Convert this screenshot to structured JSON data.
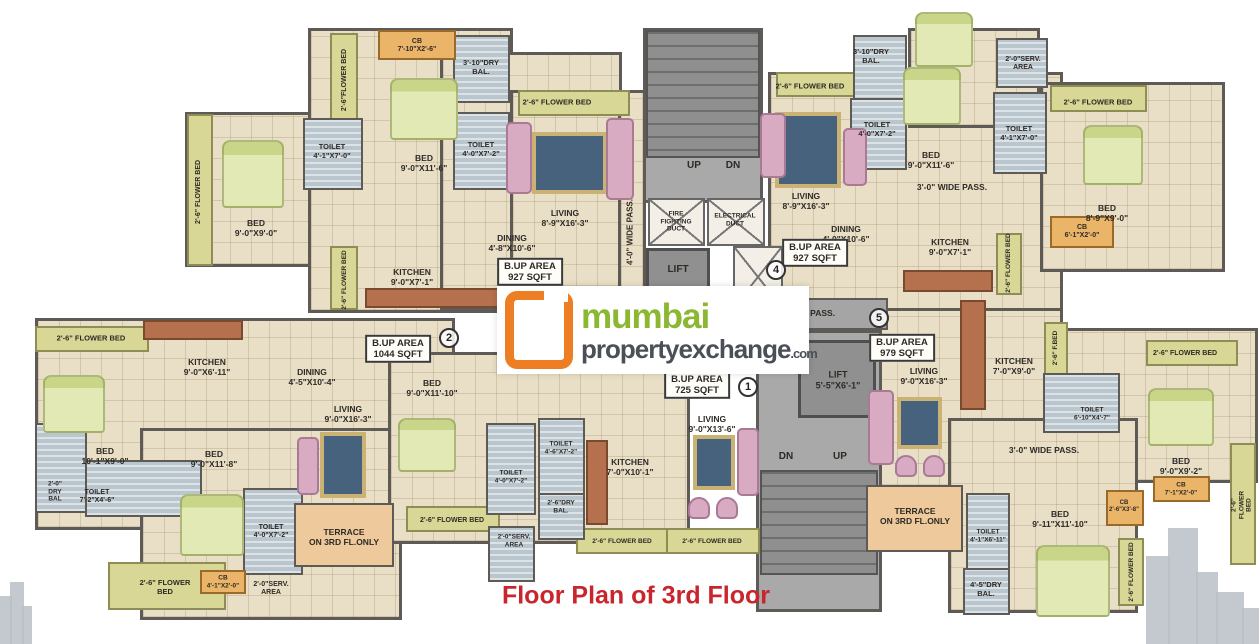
{
  "caption": "Floor Plan of 3rd Floor",
  "logo": {
    "icon": "orange-square-bracket",
    "line1": "mumbai",
    "line2": "propertyexchange",
    "suffix": ".com"
  },
  "colors": {
    "floor": "#e9dfc6",
    "wall": "#5e5a55",
    "flower_bed": "#d8d795",
    "wet_area": "#b9c6ce",
    "cupboard": "#eab469",
    "terrace": "#eec99b",
    "core": "#a9a9a9",
    "logo_orange": "#ee7e23",
    "logo_green": "#8cb733",
    "logo_gray": "#4b5058",
    "caption_red": "#c9252d",
    "bed": "#e2e9b4",
    "rug": "#46627c",
    "sofa": "#d9abc3"
  },
  "plan": {
    "regions": [
      {
        "type": "f",
        "x": 185,
        "y": 112,
        "w": 130,
        "h": 155
      },
      {
        "type": "f",
        "x": 308,
        "y": 28,
        "w": 205,
        "h": 285
      },
      {
        "type": "f",
        "x": 440,
        "y": 52,
        "w": 182,
        "h": 258
      },
      {
        "type": "f",
        "x": 510,
        "y": 90,
        "w": 115,
        "h": 220
      },
      {
        "type": "f",
        "x": 618,
        "y": 90,
        "w": 28,
        "h": 222
      },
      {
        "type": "f",
        "x": 768,
        "y": 72,
        "w": 295,
        "h": 240
      },
      {
        "type": "f",
        "x": 1040,
        "y": 82,
        "w": 185,
        "h": 190
      },
      {
        "type": "f",
        "x": 908,
        "y": 28,
        "w": 132,
        "h": 100
      },
      {
        "type": "f",
        "x": 35,
        "y": 318,
        "w": 420,
        "h": 212
      },
      {
        "type": "f",
        "x": 140,
        "y": 428,
        "w": 262,
        "h": 192
      },
      {
        "type": "f",
        "x": 388,
        "y": 352,
        "w": 302,
        "h": 192
      },
      {
        "type": "f",
        "x": 873,
        "y": 308,
        "w": 190,
        "h": 180
      },
      {
        "type": "f",
        "x": 1058,
        "y": 328,
        "w": 200,
        "h": 155
      },
      {
        "type": "f",
        "x": 948,
        "y": 418,
        "w": 190,
        "h": 195
      },
      {
        "type": "core",
        "x": 643,
        "y": 28,
        "w": 120,
        "h": 175
      },
      {
        "type": "stairs",
        "x": 646,
        "y": 30,
        "w": 114,
        "h": 128
      },
      {
        "type": "duct",
        "x": 648,
        "y": 198,
        "w": 57,
        "h": 48
      },
      {
        "type": "duct",
        "x": 707,
        "y": 198,
        "w": 58,
        "h": 48
      },
      {
        "type": "lift",
        "x": 646,
        "y": 248,
        "w": 64,
        "h": 58
      },
      {
        "type": "duct",
        "x": 733,
        "y": 246,
        "w": 50,
        "h": 62
      },
      {
        "type": "corridor",
        "x": 640,
        "y": 298,
        "w": 248,
        "h": 32
      },
      {
        "type": "core",
        "x": 756,
        "y": 330,
        "w": 126,
        "h": 282
      },
      {
        "type": "lift",
        "x": 798,
        "y": 340,
        "w": 78,
        "h": 78
      },
      {
        "type": "stairs",
        "x": 760,
        "y": 470,
        "w": 118,
        "h": 105
      },
      {
        "type": "fl",
        "x": 187,
        "y": 114,
        "w": 26,
        "h": 152
      },
      {
        "type": "fl",
        "x": 330,
        "y": 33,
        "w": 28,
        "h": 92
      },
      {
        "type": "fl",
        "x": 518,
        "y": 90,
        "w": 112,
        "h": 26
      },
      {
        "type": "fl",
        "x": 330,
        "y": 246,
        "w": 28,
        "h": 64
      },
      {
        "type": "fl",
        "x": 776,
        "y": 72,
        "w": 92,
        "h": 25
      },
      {
        "type": "fl",
        "x": 1050,
        "y": 85,
        "w": 97,
        "h": 27
      },
      {
        "type": "fl",
        "x": 996,
        "y": 233,
        "w": 26,
        "h": 62
      },
      {
        "type": "fl",
        "x": 35,
        "y": 326,
        "w": 114,
        "h": 26
      },
      {
        "type": "fl",
        "x": 108,
        "y": 562,
        "w": 118,
        "h": 48
      },
      {
        "type": "fl",
        "x": 406,
        "y": 506,
        "w": 94,
        "h": 26
      },
      {
        "type": "fl",
        "x": 576,
        "y": 528,
        "w": 94,
        "h": 26
      },
      {
        "type": "fl",
        "x": 666,
        "y": 528,
        "w": 94,
        "h": 26
      },
      {
        "type": "fl",
        "x": 1044,
        "y": 322,
        "w": 24,
        "h": 58
      },
      {
        "type": "fl",
        "x": 1118,
        "y": 538,
        "w": 26,
        "h": 68
      },
      {
        "type": "fl",
        "x": 1146,
        "y": 340,
        "w": 92,
        "h": 26
      },
      {
        "type": "fl",
        "x": 1230,
        "y": 443,
        "w": 26,
        "h": 122
      },
      {
        "type": "h",
        "x": 453,
        "y": 35,
        "w": 57,
        "h": 68
      },
      {
        "type": "h",
        "x": 303,
        "y": 118,
        "w": 60,
        "h": 72
      },
      {
        "type": "h",
        "x": 453,
        "y": 112,
        "w": 57,
        "h": 78
      },
      {
        "type": "h",
        "x": 853,
        "y": 35,
        "w": 54,
        "h": 88
      },
      {
        "type": "h",
        "x": 850,
        "y": 98,
        "w": 57,
        "h": 72
      },
      {
        "type": "h",
        "x": 993,
        "y": 92,
        "w": 54,
        "h": 82
      },
      {
        "type": "h",
        "x": 996,
        "y": 38,
        "w": 52,
        "h": 50
      },
      {
        "type": "h",
        "x": 35,
        "y": 423,
        "w": 52,
        "h": 90
      },
      {
        "type": "h",
        "x": 85,
        "y": 460,
        "w": 117,
        "h": 57
      },
      {
        "type": "h",
        "x": 243,
        "y": 488,
        "w": 60,
        "h": 87
      },
      {
        "type": "h",
        "x": 486,
        "y": 423,
        "w": 50,
        "h": 92
      },
      {
        "type": "h",
        "x": 538,
        "y": 418,
        "w": 47,
        "h": 77
      },
      {
        "type": "h",
        "x": 538,
        "y": 493,
        "w": 47,
        "h": 47
      },
      {
        "type": "h",
        "x": 488,
        "y": 526,
        "w": 47,
        "h": 56
      },
      {
        "type": "h",
        "x": 966,
        "y": 493,
        "w": 44,
        "h": 77
      },
      {
        "type": "h",
        "x": 963,
        "y": 568,
        "w": 47,
        "h": 47
      },
      {
        "type": "h",
        "x": 1043,
        "y": 373,
        "w": 77,
        "h": 60
      },
      {
        "type": "cb",
        "x": 378,
        "y": 30,
        "w": 78,
        "h": 30
      },
      {
        "type": "cb",
        "x": 1050,
        "y": 216,
        "w": 64,
        "h": 32
      },
      {
        "type": "cb",
        "x": 200,
        "y": 570,
        "w": 46,
        "h": 24
      },
      {
        "type": "cb",
        "x": 1153,
        "y": 476,
        "w": 57,
        "h": 26
      },
      {
        "type": "cb",
        "x": 1106,
        "y": 490,
        "w": 38,
        "h": 36
      },
      {
        "type": "t",
        "x": 294,
        "y": 503,
        "w": 100,
        "h": 64
      },
      {
        "type": "t",
        "x": 866,
        "y": 485,
        "w": 97,
        "h": 67
      }
    ],
    "furniture": [
      {
        "type": "bed",
        "x": 390,
        "y": 78,
        "w": 68,
        "h": 62
      },
      {
        "type": "bed",
        "x": 222,
        "y": 140,
        "w": 62,
        "h": 68
      },
      {
        "type": "bed",
        "x": 903,
        "y": 67,
        "w": 58,
        "h": 58
      },
      {
        "type": "bed",
        "x": 1083,
        "y": 125,
        "w": 60,
        "h": 60
      },
      {
        "type": "bed",
        "x": 915,
        "y": 12,
        "w": 58,
        "h": 55
      },
      {
        "type": "bed",
        "x": 43,
        "y": 375,
        "w": 62,
        "h": 58
      },
      {
        "type": "bed",
        "x": 180,
        "y": 494,
        "w": 64,
        "h": 62
      },
      {
        "type": "bed",
        "x": 398,
        "y": 418,
        "w": 58,
        "h": 54
      },
      {
        "type": "bed",
        "x": 1036,
        "y": 545,
        "w": 74,
        "h": 72
      },
      {
        "type": "bed",
        "x": 1148,
        "y": 388,
        "w": 66,
        "h": 58
      },
      {
        "type": "rug",
        "x": 532,
        "y": 132,
        "w": 75,
        "h": 62
      },
      {
        "type": "rug",
        "x": 775,
        "y": 112,
        "w": 66,
        "h": 76
      },
      {
        "type": "rug",
        "x": 320,
        "y": 432,
        "w": 46,
        "h": 66
      },
      {
        "type": "rug",
        "x": 693,
        "y": 435,
        "w": 42,
        "h": 55
      },
      {
        "type": "rug",
        "x": 897,
        "y": 397,
        "w": 45,
        "h": 52
      },
      {
        "type": "sofa",
        "x": 506,
        "y": 122,
        "w": 26,
        "h": 72
      },
      {
        "type": "sofa",
        "x": 606,
        "y": 118,
        "w": 28,
        "h": 82
      },
      {
        "type": "sofa",
        "x": 760,
        "y": 113,
        "w": 26,
        "h": 65
      },
      {
        "type": "sofa",
        "x": 843,
        "y": 128,
        "w": 24,
        "h": 58
      },
      {
        "type": "sofa",
        "x": 297,
        "y": 437,
        "w": 22,
        "h": 58
      },
      {
        "type": "sofa",
        "x": 737,
        "y": 428,
        "w": 22,
        "h": 68
      },
      {
        "type": "sofa",
        "x": 868,
        "y": 390,
        "w": 26,
        "h": 75
      },
      {
        "type": "chair",
        "x": 688,
        "y": 497,
        "w": 22,
        "h": 22
      },
      {
        "type": "chair",
        "x": 716,
        "y": 497,
        "w": 22,
        "h": 22
      },
      {
        "type": "chair",
        "x": 895,
        "y": 455,
        "w": 22,
        "h": 22
      },
      {
        "type": "chair",
        "x": 923,
        "y": 455,
        "w": 22,
        "h": 22
      },
      {
        "type": "counter",
        "x": 365,
        "y": 288,
        "w": 135,
        "h": 20
      },
      {
        "type": "counter",
        "x": 903,
        "y": 270,
        "w": 90,
        "h": 22
      },
      {
        "type": "counter",
        "x": 143,
        "y": 320,
        "w": 100,
        "h": 20
      },
      {
        "type": "counter",
        "x": 586,
        "y": 440,
        "w": 22,
        "h": 85
      },
      {
        "type": "counter",
        "x": 960,
        "y": 300,
        "w": 26,
        "h": 110
      }
    ]
  },
  "labels": [
    {
      "t": "2'-6\"FLOWER BED",
      "x": 345,
      "y": 80,
      "r": 1,
      "s": 7
    },
    {
      "t": "CB\n7'-10\"X2'-6\"",
      "x": 417,
      "y": 46,
      "s": 7
    },
    {
      "t": "3'-10\"DRY\nBAL.",
      "x": 481,
      "y": 68,
      "s": 7.5
    },
    {
      "t": "2'-6\" FLOWER BED",
      "x": 557,
      "y": 103,
      "s": 7.5
    },
    {
      "t": "TOILET\n4'-1\"X7'-0\"",
      "x": 332,
      "y": 152,
      "s": 7.5
    },
    {
      "t": "TOILET\n4'-0\"X7'-2\"",
      "x": 481,
      "y": 150,
      "s": 7.5
    },
    {
      "t": "BED\n9'-0\"X11'-6\"",
      "x": 424,
      "y": 163,
      "s": 8.5
    },
    {
      "t": "2'-6\" FLOWER BED",
      "x": 199,
      "y": 192,
      "r": 1,
      "s": 7
    },
    {
      "t": "BED\n9'-0\"X9'-0\"",
      "x": 256,
      "y": 228,
      "s": 8.5
    },
    {
      "t": "KITCHEN\n9'-0\"X7'-1\"",
      "x": 412,
      "y": 277,
      "s": 8.5
    },
    {
      "t": "2'-6\" FLOWER BED",
      "x": 345,
      "y": 280,
      "r": 1,
      "s": 6.5
    },
    {
      "t": "LIVING\n8'-9\"X16'-3\"",
      "x": 565,
      "y": 218,
      "s": 8.5
    },
    {
      "t": "DINING\n4'-8\"X10'-6\"",
      "x": 512,
      "y": 243,
      "s": 8.5
    },
    {
      "t": "B.UP AREA\n927 SQFT",
      "x": 530,
      "y": 272,
      "box": 1
    },
    {
      "t": "4'-0\" WIDE PASS.",
      "x": 630,
      "y": 232,
      "r": 1,
      "s": 8
    },
    {
      "t": "UP",
      "x": 694,
      "y": 166,
      "s": 10
    },
    {
      "t": "DN",
      "x": 733,
      "y": 166,
      "s": 10
    },
    {
      "t": "FIRE\nFIGHTING\nDUCT",
      "x": 676,
      "y": 222,
      "s": 6.5
    },
    {
      "t": "ELECTRICAL\nDUCT",
      "x": 735,
      "y": 220,
      "s": 6.5
    },
    {
      "t": "LIFT",
      "x": 678,
      "y": 270,
      "s": 10
    },
    {
      "t": "2'-6\" FLOWER BED",
      "x": 810,
      "y": 87,
      "s": 7.5
    },
    {
      "t": "3'-10\"DRY\nBAL.",
      "x": 871,
      "y": 57,
      "s": 7.5
    },
    {
      "t": "TOILET\n4'-0\"X7'-2\"",
      "x": 877,
      "y": 130,
      "s": 7.5
    },
    {
      "t": "BED\n9'-0\"X11'-6\"",
      "x": 931,
      "y": 160,
      "s": 8.5
    },
    {
      "t": "LIVING\n8'-9\"X16'-3\"",
      "x": 806,
      "y": 201,
      "s": 8.5
    },
    {
      "t": "DINING\n4'-0\"X10'-6\"",
      "x": 846,
      "y": 234,
      "s": 8.5
    },
    {
      "t": "B.UP AREA\n927 SQFT",
      "x": 815,
      "y": 253,
      "box": 1
    },
    {
      "t": "3'-0\" WIDE PASS.",
      "x": 952,
      "y": 187,
      "s": 8.5
    },
    {
      "t": "KITCHEN\n9'-0\"X7'-1\"",
      "x": 950,
      "y": 247,
      "s": 8.5
    },
    {
      "t": "2'-0\"SERV.\nAREA",
      "x": 1023,
      "y": 64,
      "s": 7
    },
    {
      "t": "TOILET\n4'-1\"X7'-0\"",
      "x": 1019,
      "y": 134,
      "s": 7.5
    },
    {
      "t": "2'-6\" FLOWER BED",
      "x": 1098,
      "y": 103,
      "s": 7.5
    },
    {
      "t": "BED\n8'-9\"X9'-0\"",
      "x": 1107,
      "y": 213,
      "s": 8.5
    },
    {
      "t": "CB\n6'-1\"X2'-0\"",
      "x": 1082,
      "y": 232,
      "s": 7
    },
    {
      "t": "2'-6\" FLOWER BED",
      "x": 1009,
      "y": 263,
      "r": 1,
      "s": 6.5
    },
    {
      "t": "4'-0\" WIDE PASS.",
      "x": 800,
      "y": 313,
      "s": 8.5
    },
    {
      "t": "2'-6\" FLOWER BED",
      "x": 91,
      "y": 339,
      "s": 7.5
    },
    {
      "t": "KITCHEN\n9'-0\"X6'-11\"",
      "x": 207,
      "y": 367,
      "s": 8.5
    },
    {
      "t": "DINING\n4'-5\"X10'-4\"",
      "x": 312,
      "y": 377,
      "s": 8.5
    },
    {
      "t": "B.UP AREA\n1044 SQFT",
      "x": 398,
      "y": 349,
      "box": 1
    },
    {
      "t": "LIVING\n9'-0\"X16'-3\"",
      "x": 348,
      "y": 414,
      "s": 8.5
    },
    {
      "t": "BED\n10'-1\"X9'-0\"",
      "x": 105,
      "y": 456,
      "s": 8.5
    },
    {
      "t": "2'-0\"\nDRY\nBAL",
      "x": 55,
      "y": 492,
      "s": 6.5
    },
    {
      "t": "TOILET\n7'-2\"X4'-6\"",
      "x": 97,
      "y": 497,
      "s": 7
    },
    {
      "t": "BED\n9'-0\"X11'-8\"",
      "x": 214,
      "y": 459,
      "s": 8.5
    },
    {
      "t": "2'-6\" FLOWER\nBED",
      "x": 165,
      "y": 588,
      "s": 7.5
    },
    {
      "t": "CB\n4'-1\"X2'-0\"",
      "x": 223,
      "y": 582,
      "s": 6.5
    },
    {
      "t": "2'-0\"SERV.\nAREA",
      "x": 271,
      "y": 589,
      "s": 7
    },
    {
      "t": "TOILET\n4'-0\"X7'-2\"",
      "x": 271,
      "y": 532,
      "s": 7
    },
    {
      "t": "TERRACE\nON 3RD FL.ONLY",
      "x": 344,
      "y": 537,
      "s": 8.5
    },
    {
      "t": "2'-6\" FLOWER BED",
      "x": 452,
      "y": 521,
      "s": 7
    },
    {
      "t": "BED\n9'-0\"X11'-10\"",
      "x": 432,
      "y": 388,
      "s": 8.5
    },
    {
      "t": "TOILET\n4'-0\"X7'-2\"",
      "x": 511,
      "y": 477,
      "s": 6.5
    },
    {
      "t": "TOILET\n4'-6\"X7'-2\"",
      "x": 561,
      "y": 448,
      "s": 6.5
    },
    {
      "t": "2'-6\"DRY\nBAL.",
      "x": 561,
      "y": 507,
      "s": 6.5
    },
    {
      "t": "KITCHEN\n7'-0\"X10'-1\"",
      "x": 630,
      "y": 467,
      "s": 8.5
    },
    {
      "t": "2'-0\"SERV.\nAREA",
      "x": 514,
      "y": 541,
      "s": 6.5
    },
    {
      "t": "2'-6\" FLOWER BED",
      "x": 622,
      "y": 542,
      "s": 6.5
    },
    {
      "t": "2'-6\" FLOWER BED",
      "x": 712,
      "y": 542,
      "s": 6.5
    },
    {
      "t": "LIVING\n9'-0\"X13'-6\"",
      "x": 712,
      "y": 424,
      "s": 8.5
    },
    {
      "t": "B.UP AREA\n725 SQFT",
      "x": 697,
      "y": 385,
      "box": 1
    },
    {
      "t": "LIFT\n5'-5\"X6'-1\"",
      "x": 838,
      "y": 380,
      "s": 9
    },
    {
      "t": "DN",
      "x": 786,
      "y": 457,
      "s": 10
    },
    {
      "t": "UP",
      "x": 840,
      "y": 457,
      "s": 10
    },
    {
      "t": "B.UP AREA\n979 SQFT",
      "x": 902,
      "y": 348,
      "box": 1
    },
    {
      "t": "LIVING\n9'-0\"X16'-3\"",
      "x": 924,
      "y": 376,
      "s": 8.5
    },
    {
      "t": "KITCHEN\n7'-0\"X9'-0\"",
      "x": 1014,
      "y": 366,
      "s": 8.5
    },
    {
      "t": "2'-6\" F.BED",
      "x": 1056,
      "y": 348,
      "r": 1,
      "s": 6.5
    },
    {
      "t": "TOILET\n6'-10\"X4'-7\"",
      "x": 1092,
      "y": 414,
      "s": 6.5
    },
    {
      "t": "3'-0\" WIDE PASS.",
      "x": 1044,
      "y": 450,
      "s": 8.5
    },
    {
      "t": "TERRACE\nON 3RD FL.ONLY",
      "x": 915,
      "y": 516,
      "s": 8.5
    },
    {
      "t": "BED\n9'-11\"X11'-10\"",
      "x": 1060,
      "y": 519,
      "s": 8.5
    },
    {
      "t": "TOILET\n4'-1\"X6'-11\"",
      "x": 988,
      "y": 536,
      "s": 6.5
    },
    {
      "t": "4'-5\"DRY\nBAL.",
      "x": 986,
      "y": 590,
      "s": 7.5
    },
    {
      "t": "2'-6\" FLOWER BED",
      "x": 1132,
      "y": 572,
      "r": 1,
      "s": 6.5
    },
    {
      "t": "BED\n9'-0\"X9'-2\"",
      "x": 1181,
      "y": 466,
      "s": 8.5
    },
    {
      "t": "CB\n2'-6\"X3'-8\"",
      "x": 1124,
      "y": 507,
      "s": 6
    },
    {
      "t": "CB\n7'-1\"X2'-0\"",
      "x": 1181,
      "y": 489,
      "s": 6.5
    },
    {
      "t": "2'-6\" FLOWER BED",
      "x": 1185,
      "y": 354,
      "s": 7
    },
    {
      "t": "2'-6\" FLOWER BED",
      "x": 1242,
      "y": 505,
      "r": 1,
      "s": 6.5
    }
  ],
  "markers": [
    {
      "n": "1",
      "x": 748,
      "y": 387
    },
    {
      "n": "2",
      "x": 449,
      "y": 338
    },
    {
      "n": "4",
      "x": 776,
      "y": 270
    },
    {
      "n": "5",
      "x": 879,
      "y": 318
    }
  ],
  "deco": [
    {
      "x": 0,
      "y": 596,
      "w": 12,
      "h": 48
    },
    {
      "x": 10,
      "y": 582,
      "w": 14,
      "h": 62
    },
    {
      "x": 22,
      "y": 606,
      "w": 10,
      "h": 38
    },
    {
      "x": 1146,
      "y": 556,
      "w": 24,
      "h": 88
    },
    {
      "x": 1168,
      "y": 528,
      "w": 30,
      "h": 116
    },
    {
      "x": 1196,
      "y": 572,
      "w": 22,
      "h": 72
    },
    {
      "x": 1216,
      "y": 592,
      "w": 28,
      "h": 52
    },
    {
      "x": 1242,
      "y": 608,
      "w": 17,
      "h": 36
    }
  ]
}
